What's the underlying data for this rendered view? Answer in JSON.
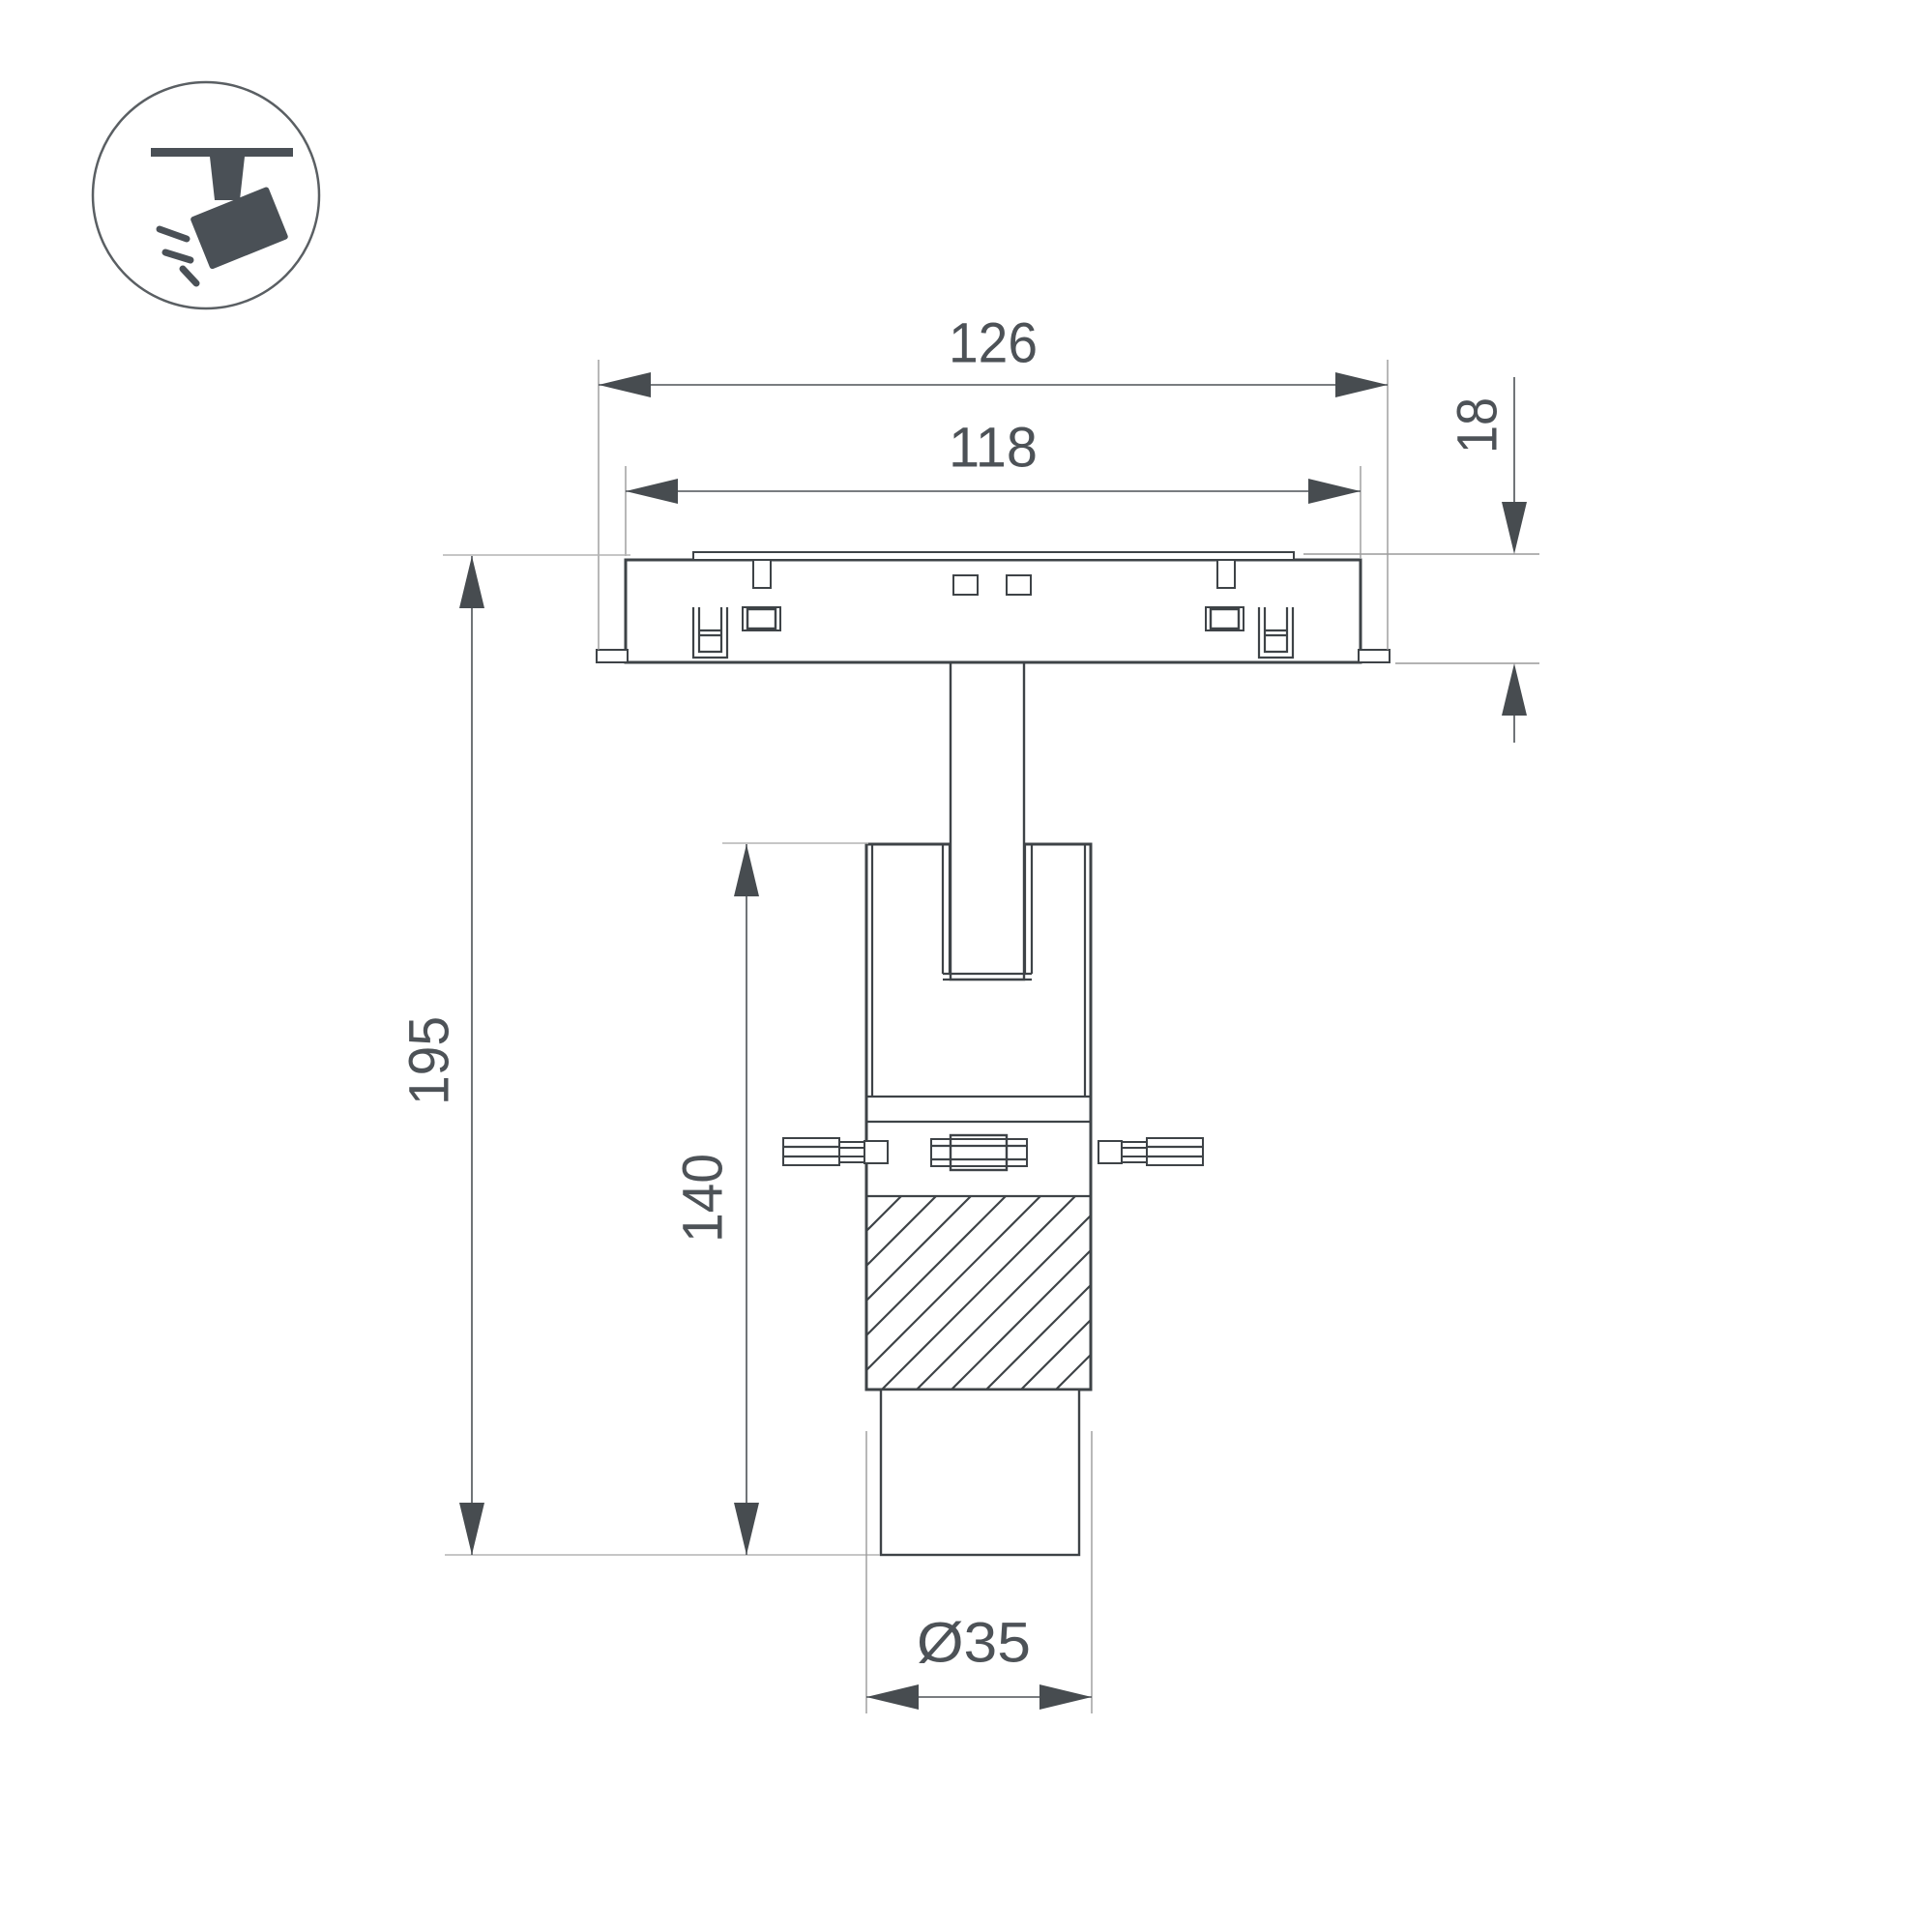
{
  "icon": {
    "name": "track-spotlight-icon"
  },
  "dimensions": {
    "overall_width": "126",
    "inner_width": "118",
    "track_depth": "18",
    "total_height": "195",
    "body_height": "140",
    "diameter": "Ø35"
  },
  "colors": {
    "object_line": "#3e4347",
    "dimension_line": "#4d5257",
    "extension_line": "#9a9a9a",
    "icon_fill": "#4a5056",
    "background": "#ffffff"
  }
}
